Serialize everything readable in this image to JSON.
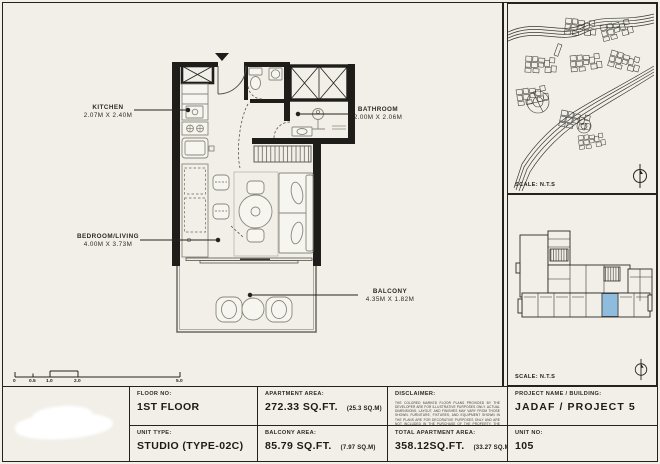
{
  "colors": {
    "paper": "#f1efe8",
    "ink": "#26231d",
    "unit_highlight": "#8fbbdd"
  },
  "plan_labels": {
    "kitchen": {
      "name": "KITCHEN",
      "dims": "2.07M X 2.40M"
    },
    "bathroom": {
      "name": "BATHROOM",
      "dims": "2.00M X 2.06M"
    },
    "bedroom_living": {
      "name": "BEDROOM/LIVING",
      "dims": "4.00M X 3.73M"
    },
    "balcony": {
      "name": "BALCONY",
      "dims": "4.35M X 1.82M"
    }
  },
  "scale_bar": {
    "labels": [
      "0",
      "0.5",
      "1.0",
      "2.0",
      "5.0"
    ]
  },
  "panels": {
    "map_scale_label": "SCALE: N.T.S",
    "keyplan_scale_label": "SCALE: N.T.S"
  },
  "title_block": {
    "floor_no_label": "FLOOR NO:",
    "floor_no": "1ST FLOOR",
    "unit_type_label": "UNIT TYPE:",
    "unit_type": "STUDIO (TYPE-02C)",
    "apartment_area_label": "APARTMENT AREA:",
    "apartment_area": "272.33 SQ.FT.",
    "apartment_area_m": "(25.3 SQ.M)",
    "balcony_area_label": "BALCONY AREA:",
    "balcony_area": "85.79 SQ.FT.",
    "balcony_area_m": "(7.97 SQ.M)",
    "disclaimer_label": "DISCLAIMER:",
    "disclaimer_text": "THE COLORED MARKED FLOOR PLANS PROVIDED BY THE DEVELOPER ARE FOR ILLUSTRATIVE PURPOSES ONLY. ACTUAL DIMENSIONS, LAYOUT, AND FINISHES MAY VARY FROM THOSE SHOWN. FURNITURE, FIXTURES, AND EQUIPMENT SHOWN IN THE PLANS ARE FOR DECORATIVE PURPOSES ONLY AND ARE NOT INCLUDED IN THE PURCHASE OF THE PROPERTY. THE DEVELOPER RESERVES THE RIGHT TO MAKE MODIFICATIONS, REVISIONS, AND CHANGES TO THE GIVEN PLANS, SPECIFICATIONS, AND FEATURES WITHOUT PRIOR NOTICE.",
    "total_area_label": "TOTAL APARTMENT AREA:",
    "total_area": "358.12SQ.FT.",
    "total_area_m": "(33.27 SQ.M)",
    "project_label": "PROJECT NAME / BUILDING:",
    "project": "JADAF / PROJECT 5",
    "unit_no_label": "UNIT NO:",
    "unit_no": "105"
  }
}
